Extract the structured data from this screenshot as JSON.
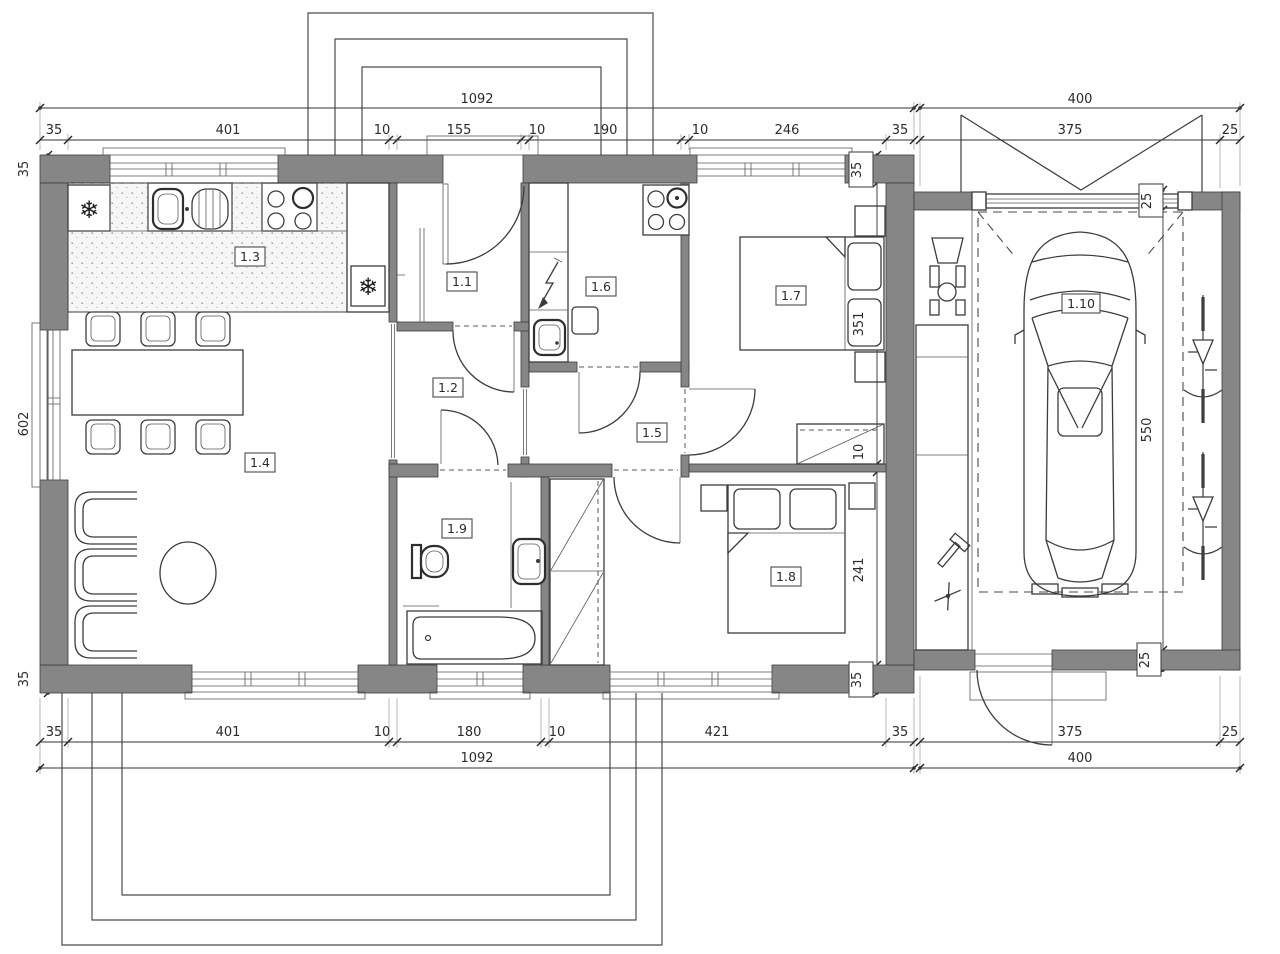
{
  "plan_title": "single-storey house floor plan with garage",
  "rooms": [
    {
      "id": "1.1"
    },
    {
      "id": "1.2"
    },
    {
      "id": "1.3"
    },
    {
      "id": "1.4"
    },
    {
      "id": "1.5"
    },
    {
      "id": "1.6"
    },
    {
      "id": "1.7"
    },
    {
      "id": "1.8"
    },
    {
      "id": "1.9"
    },
    {
      "id": "1.10"
    }
  ],
  "symbols": {
    "fridge": "❄",
    "freezer": "❄"
  },
  "dims": {
    "top_total": "1092",
    "garage_top_total": "400",
    "top": [
      "35",
      "401",
      "10",
      "155",
      "10",
      "190",
      "10",
      "246",
      "35"
    ],
    "garage_top": [
      "375",
      "25"
    ],
    "bottom": [
      "35",
      "401",
      "10",
      "180",
      "10",
      "421",
      "35"
    ],
    "garage_bottom": [
      "375",
      "25"
    ],
    "bottom_total": "1092",
    "garage_bottom_total": "400",
    "left": [
      "35",
      "602",
      "35"
    ],
    "right": [
      "35",
      "351",
      "10",
      "241",
      "35"
    ],
    "garage_right": [
      "25",
      "550",
      "25"
    ]
  },
  "colors": {
    "wall": "#868686",
    "line": "#3c3c3c",
    "background": "#ffffff"
  }
}
